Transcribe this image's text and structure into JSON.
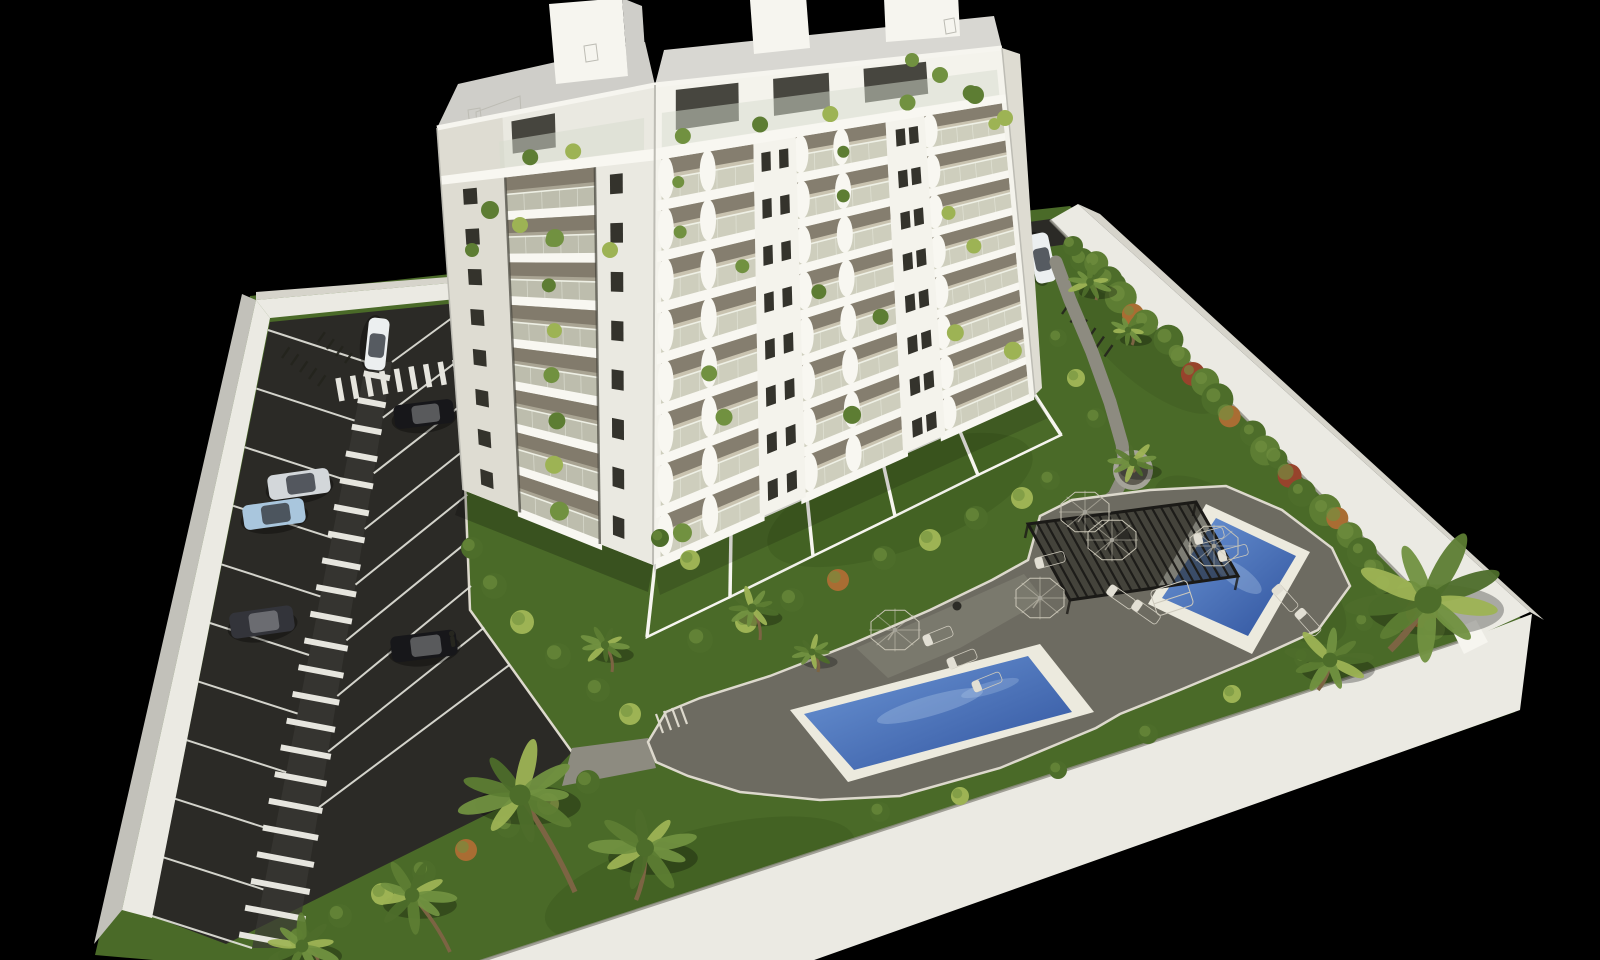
{
  "meta": {
    "description": "Aerial 3D architectural rendering on a black background: a white multi-storey apartment building with plant-filled balconies, a fenced parking lot with marked stalls and a striped pedestrian walkway, landscaped gardens with palm trees and hedges, a long lap pool, a smaller plunge pool, a dark slatted pergola, white parasols and sun loungers, all enclosed by a white perimeter wall."
  },
  "palette": {
    "bg": "#000000",
    "grass": "#4a6a28",
    "grassD": "#36511c",
    "asphalt": "#2b2a26",
    "asphaltL": "#3a3934",
    "stripe": "#e6e5de",
    "wallTop": "#ebeae3",
    "wallFace": "#d6d4cb",
    "wallOuter": "#c2c1ba",
    "wallInner": "#8f8d83",
    "curb": "#ddd9cd",
    "path": "#8d8b80",
    "deck": "#6d6b61",
    "deckL": "#7d7b70",
    "coping": "#eceade",
    "waterL": "#6d97d6",
    "waterD": "#30539e",
    "glint": "#bcd4ee",
    "pergola": "#23221e",
    "slat": "#1b1a17",
    "white": "#f6f5ef",
    "facade": "#f4f3ec",
    "facadeShade": "#eae9e1",
    "strip": "#dedcd2",
    "floor": "#c9c3b0",
    "floorShade": "#a9a493",
    "shadowBand": "#7d7768",
    "glass": "#d5dbce",
    "glassline": "#f0f2e8",
    "window": "#34332c",
    "roof": "#cfcec9",
    "roofL": "#d8d7d2",
    "slab": "#f8f7f1",
    "edge": "#bdbcb4",
    "post": "#45433a",
    "terr": "#4e6c2b",
    "leaf1": "#4d6d2a",
    "leaf2": "#719140",
    "leaf3": "#5d7d33",
    "leafLt": "#9db354",
    "leafO": "#a96d33",
    "leafR": "#97432c",
    "trunk": "#7c6443",
    "umb": "#f4f2e8",
    "umbEdge": "#c9c5b6",
    "loung": "#f1efe6",
    "loungEdge": "#cdc9bc",
    "loungHead": "#e2dfd4",
    "dark": "#2c2b26",
    "person": "#26261f",
    "rack": "#24231d",
    "planterRim": "#a5a399",
    "planterIn": "#5e5b51",
    "carBlack": "#17171a",
    "carGray": "#33343a",
    "carWhite": "#eceff0",
    "carSilver": "#d3d7da",
    "carBlue": "#a9c6dd",
    "cabin": "#3c4148"
  },
  "scene": {
    "counts": {
      "pools": 2,
      "cars": 7,
      "parasols": 5,
      "sun_loungers": 10,
      "palm_trees": 12,
      "building_floors_visible": 9
    },
    "building": {
      "floors": 8,
      "v0": 0.145,
      "se_bays": [
        [
          0.02,
          0.28
        ],
        [
          0.4,
          0.655
        ],
        [
          0.765,
          0.985
        ]
      ],
      "se_piers": [
        [
          0.28,
          0.4
        ],
        [
          0.655,
          0.765
        ],
        [
          0.985,
          1.0
        ]
      ],
      "se_pier_windows": [
        [
          0.315,
          0.365
        ],
        [
          0.695,
          0.732
        ],
        []
      ],
      "sw_bay": [
        0.3,
        0.72
      ],
      "sw_strip_window": [
        0.1,
        0.165
      ],
      "sw_pier_window": [
        0.79,
        0.85
      ],
      "penthouse_plants_se": [
        0.08,
        0.3,
        0.5,
        0.72,
        0.9
      ],
      "penthouse_plants_sw": [
        0.42,
        0.62
      ],
      "balcony_plants_se": [
        [
          0,
          0.18
        ],
        [
          0,
          0.52
        ],
        [
          0,
          0.88
        ],
        [
          1,
          0.2
        ],
        [
          1,
          0.5
        ],
        [
          2,
          0.22
        ],
        [
          2,
          0.86
        ],
        [
          3,
          0.2
        ],
        [
          3,
          0.5
        ],
        [
          4,
          0.5
        ],
        [
          4,
          0.84
        ],
        [
          5,
          0.2
        ],
        [
          5,
          0.65
        ],
        [
          6,
          0.5
        ],
        [
          6,
          0.86
        ],
        [
          7,
          0.22
        ]
      ],
      "balcony_plants_sw": [
        [
          1,
          0.5
        ],
        [
          2,
          0.45
        ],
        [
          3,
          0.5
        ],
        [
          4,
          0.45
        ],
        [
          5,
          0.5
        ],
        [
          6,
          0.45
        ],
        [
          7,
          0.5
        ]
      ]
    },
    "parking": {
      "left_stall_lines": 11,
      "right_stall_lines": 9,
      "zebra_stripes": 22,
      "crosswalk_top_stripes": 11,
      "crosswalk_drive_stripes": 6
    },
    "bike_racks": [
      {
        "x": 282,
        "y": 358,
        "n": 5,
        "dx": 9,
        "dy": 7,
        "len": 13
      },
      {
        "x": 318,
        "y": 342,
        "n": 4,
        "dx": 9,
        "dy": 7,
        "len": 12
      },
      {
        "x": 1062,
        "y": 314,
        "n": 6,
        "dx": 8.5,
        "dy": 8.5,
        "len": 14
      }
    ],
    "cars": [
      {
        "x": 377,
        "y": 344,
        "a": 96,
        "c": "White",
        "w": 52,
        "h": 21
      },
      {
        "x": 424,
        "y": 414,
        "a": -7,
        "c": "Black",
        "w": 60,
        "h": 24
      },
      {
        "x": 299,
        "y": 484,
        "a": -8,
        "c": "Silver",
        "w": 62,
        "h": 25
      },
      {
        "x": 274,
        "y": 514,
        "a": -8,
        "c": "Blue",
        "w": 62,
        "h": 25
      },
      {
        "x": 262,
        "y": 622,
        "a": -8,
        "c": "Gray",
        "w": 64,
        "h": 26
      },
      {
        "x": 424,
        "y": 646,
        "a": -7,
        "c": "Black",
        "w": 66,
        "h": 26
      },
      {
        "x": 1042,
        "y": 258,
        "a": 78,
        "c": "White",
        "w": 50,
        "h": 21
      }
    ],
    "person": [
      452,
      636
    ],
    "umbrellas": [
      [
        895,
        630
      ],
      [
        1040,
        598
      ],
      [
        1085,
        512
      ],
      [
        1112,
        540
      ],
      [
        1214,
        546
      ]
    ],
    "loungers": [
      [
        938,
        636,
        -22
      ],
      [
        962,
        659,
        -22
      ],
      [
        987,
        682,
        -22
      ],
      [
        1050,
        560,
        -15
      ],
      [
        1209,
        536,
        -15
      ],
      [
        1233,
        553,
        -15
      ],
      [
        1285,
        598,
        48
      ],
      [
        1308,
        622,
        48
      ],
      [
        1121,
        597,
        35
      ],
      [
        1146,
        612,
        35
      ]
    ],
    "daybed": [
      1172,
      598,
      -18
    ],
    "tables": [
      [
        1123,
        536
      ],
      [
        957,
        606
      ]
    ],
    "pergola": {
      "slats": 20,
      "quad": [
        [
          1028,
          524
        ],
        [
          1196,
          502
        ],
        [
          1238,
          576
        ],
        [
          1070,
          600
        ]
      ]
    },
    "palms": [
      {
        "x": 520,
        "y": 795,
        "r": 66,
        "bx": 575,
        "by": 892
      },
      {
        "x": 645,
        "y": 848,
        "r": 56,
        "bx": 636,
        "by": 900
      },
      {
        "x": 412,
        "y": 895,
        "r": 46,
        "bx": 450,
        "by": 952
      },
      {
        "x": 302,
        "y": 946,
        "r": 40,
        "bx": 318,
        "by": 960
      },
      {
        "x": 1428,
        "y": 600,
        "r": 85,
        "bx": 1390,
        "by": 650
      },
      {
        "x": 1330,
        "y": 660,
        "r": 46,
        "bx": 1318,
        "by": 690
      },
      {
        "x": 752,
        "y": 608,
        "r": 28,
        "bx": 760,
        "by": 640
      },
      {
        "x": 812,
        "y": 652,
        "r": 22,
        "bx": 818,
        "by": 672
      },
      {
        "x": 1133,
        "y": 462,
        "r": 26,
        "bx": 1133,
        "by": 472
      },
      {
        "x": 605,
        "y": 645,
        "r": 26,
        "bx": 612,
        "by": 672
      },
      {
        "x": 1090,
        "y": 282,
        "r": 24,
        "bx": 1096,
        "by": 300
      },
      {
        "x": 1128,
        "y": 330,
        "r": 20,
        "bx": 1132,
        "by": 345
      }
    ],
    "bushes": [
      [
        700,
        640,
        13,
        1
      ],
      [
        746,
        622,
        11,
        2
      ],
      [
        792,
        600,
        12,
        1
      ],
      [
        838,
        580,
        11,
        4
      ],
      [
        884,
        558,
        12,
        1
      ],
      [
        930,
        540,
        11,
        2
      ],
      [
        976,
        518,
        12,
        1
      ],
      [
        1022,
        498,
        11,
        2
      ],
      [
        1050,
        480,
        10,
        1
      ],
      [
        472,
        548,
        11,
        1
      ],
      [
        494,
        586,
        13,
        1
      ],
      [
        522,
        622,
        12,
        2
      ],
      [
        558,
        656,
        13,
        1
      ],
      [
        598,
        690,
        12,
        1
      ],
      [
        630,
        714,
        11,
        2
      ],
      [
        588,
        782,
        12,
        1
      ],
      [
        548,
        804,
        11,
        2
      ],
      [
        508,
        826,
        12,
        1
      ],
      [
        466,
        850,
        11,
        4
      ],
      [
        424,
        872,
        12,
        1
      ],
      [
        382,
        894,
        11,
        2
      ],
      [
        340,
        916,
        12,
        1
      ],
      [
        300,
        938,
        11,
        1
      ],
      [
        880,
        812,
        10,
        1
      ],
      [
        960,
        796,
        9,
        2
      ],
      [
        1058,
        770,
        9,
        1
      ],
      [
        1148,
        734,
        10,
        1
      ],
      [
        1232,
        694,
        9,
        2
      ],
      [
        1304,
        658,
        10,
        1
      ],
      [
        1364,
        622,
        9,
        1
      ],
      [
        1096,
        418,
        10,
        1
      ],
      [
        1076,
        378,
        9,
        2
      ],
      [
        1058,
        338,
        9,
        1
      ],
      [
        1082,
        260,
        12,
        1
      ],
      [
        1116,
        284,
        10,
        1
      ],
      [
        690,
        560,
        10,
        2
      ],
      [
        660,
        538,
        9,
        1
      ]
    ],
    "hedge": {
      "from": [
        1078,
        250
      ],
      "to": [
        1434,
        628
      ],
      "count": 26,
      "orange": [
        4,
        11,
        18,
        24
      ],
      "red": [
        8,
        15
      ]
    },
    "roof_plants": [
      [
        940,
        75,
        8
      ],
      [
        975,
        95,
        9
      ],
      [
        1005,
        118,
        8
      ],
      [
        912,
        60,
        7
      ],
      [
        490,
        210,
        9
      ],
      [
        520,
        225,
        8
      ],
      [
        555,
        238,
        9
      ],
      [
        472,
        250,
        7
      ],
      [
        610,
        250,
        8
      ]
    ]
  }
}
